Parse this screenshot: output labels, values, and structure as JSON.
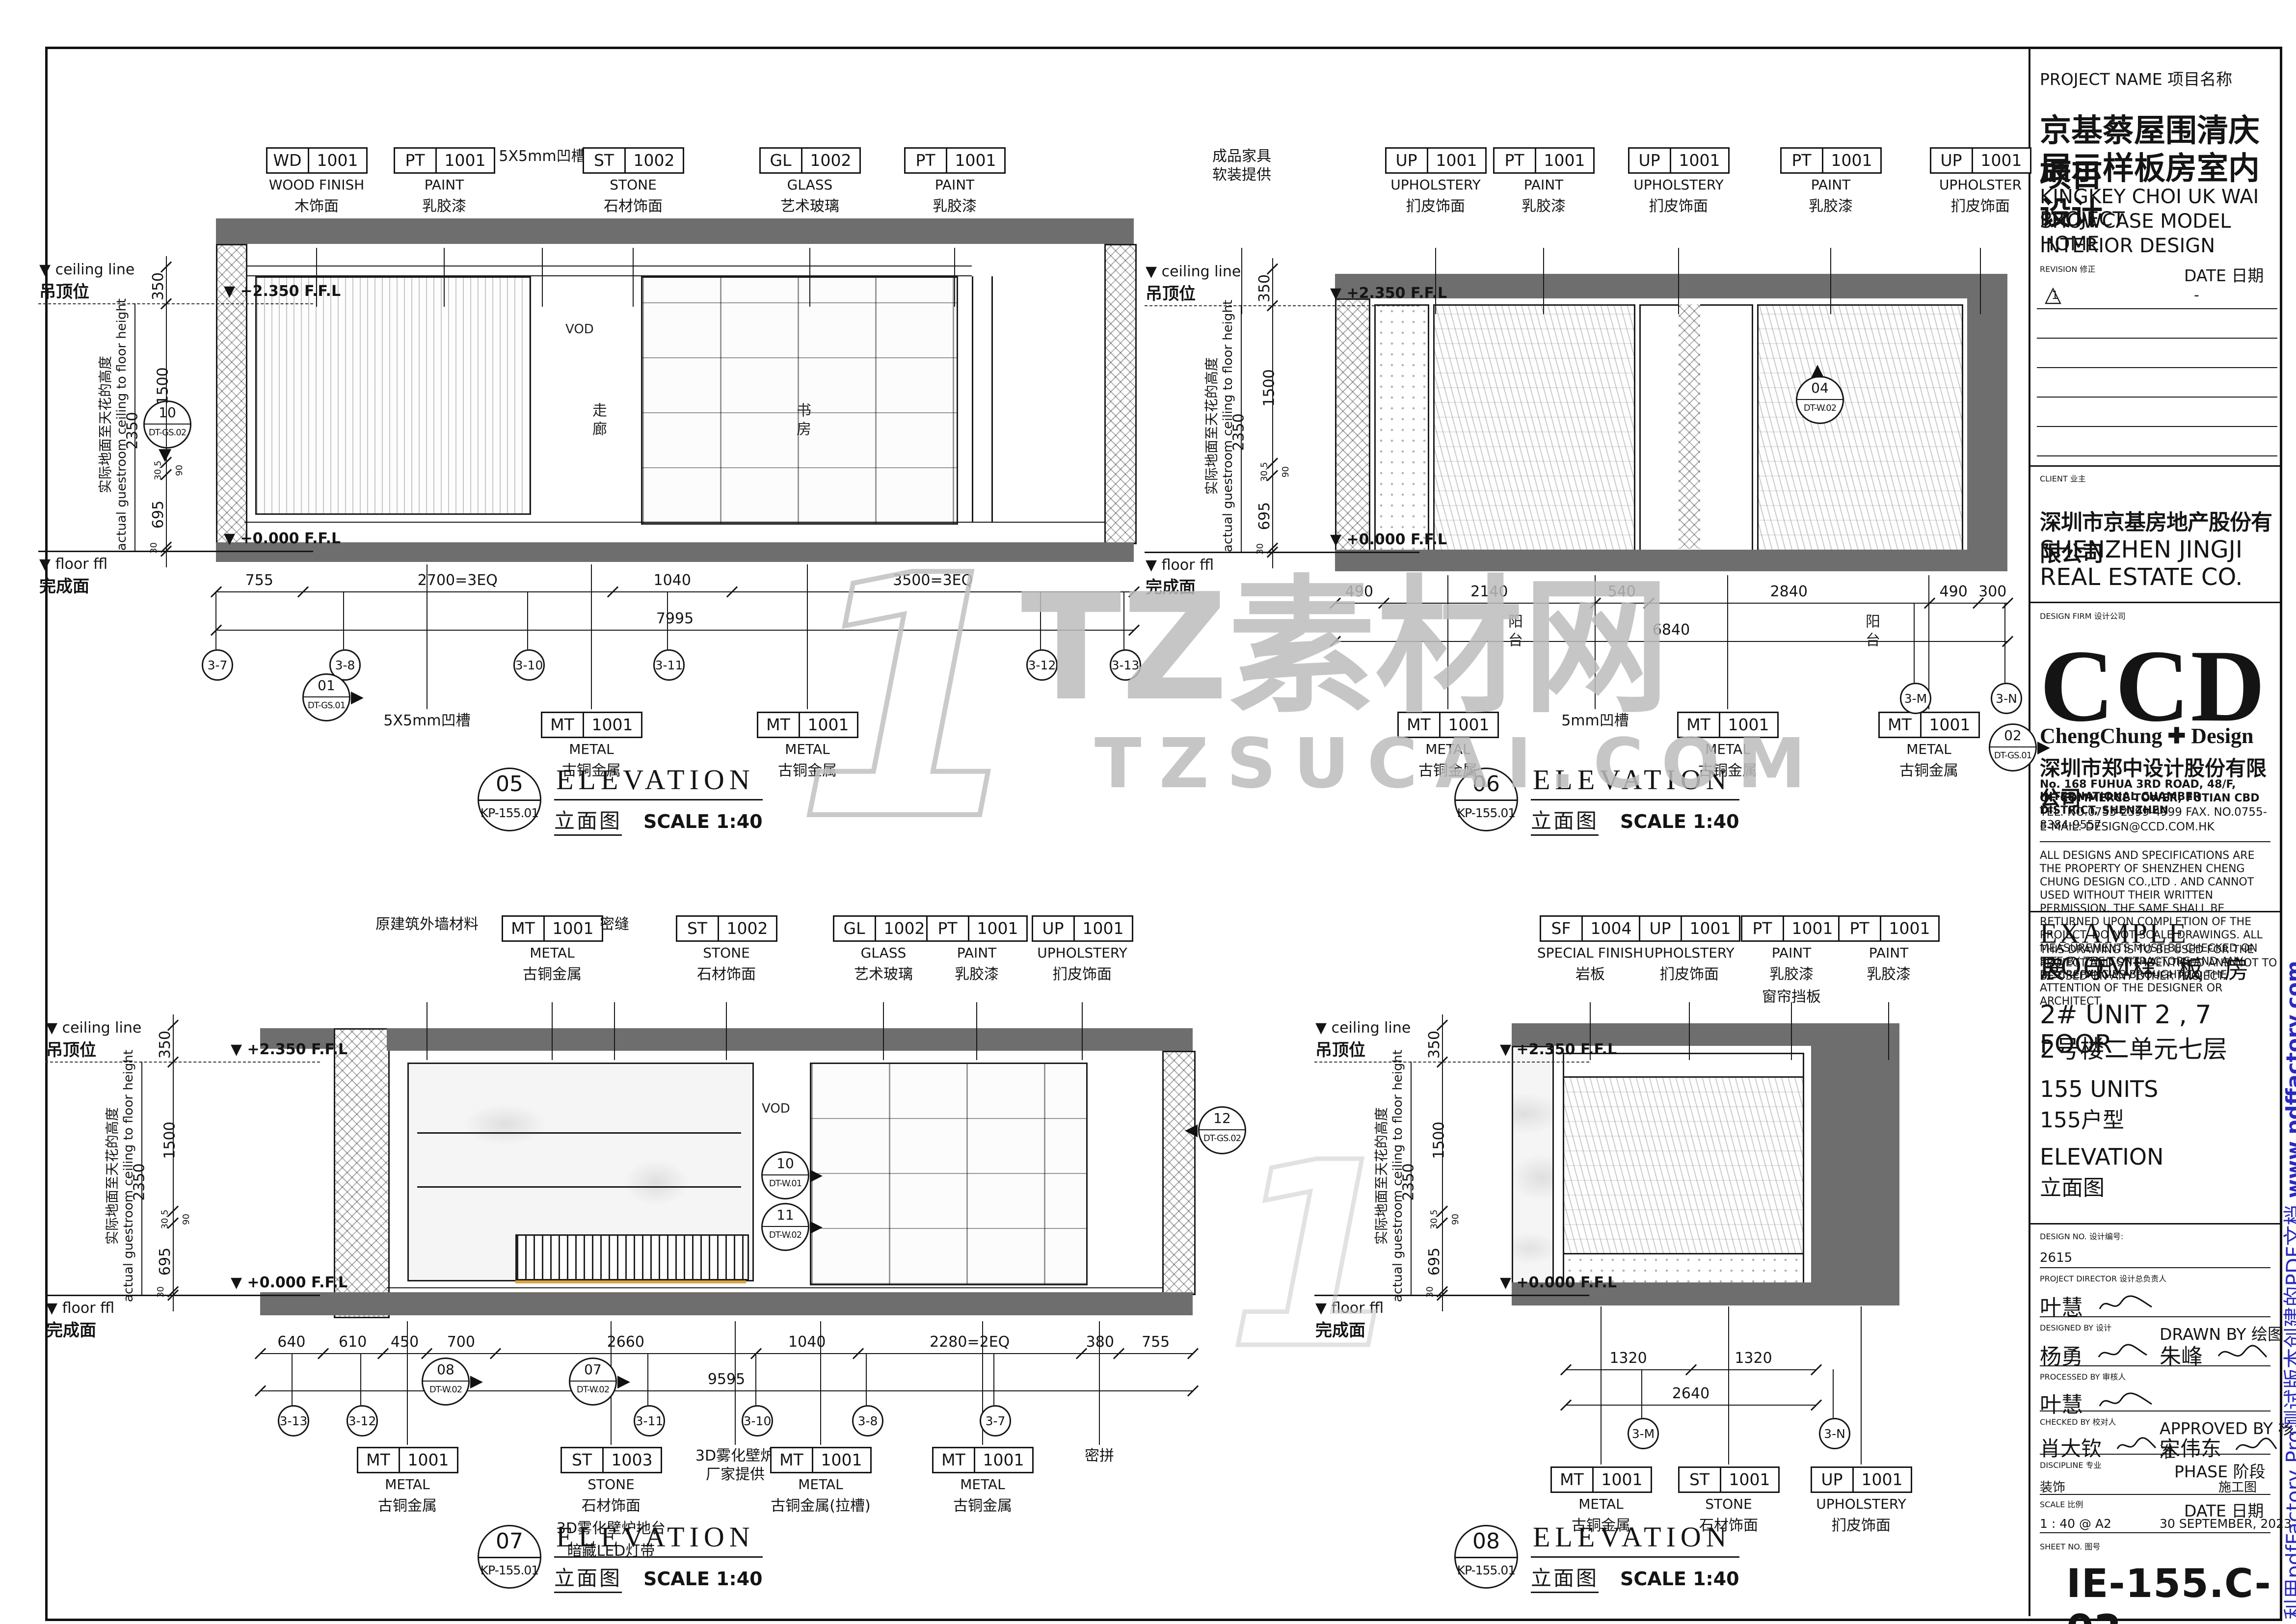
{
  "sheet": {
    "project_name_label": "PROJECT NAME 项目名称",
    "project_name_zh1": "京基蔡屋围清庆项目",
    "project_name_zh2": "展示样板房室内设计",
    "project_name_en1": "KINGKEY CHOI UK WAI PROJECT",
    "project_name_en2": "SHOWCASE MODEL HOME",
    "project_name_en3": "INTERIOR DESIGN",
    "revision_label": "REVISION 修正",
    "revision_date_label": "DATE 日期",
    "revision_mark": "1",
    "revision_date_value": "-",
    "client_label": "CLIENT 业主",
    "client_zh": "深圳市京基房地产股份有限公司",
    "client_en1": "SHENZHEN JINGJI",
    "client_en2": "REAL ESTATE CO.",
    "design_firm_label": "DESIGN FIRM 设计公司",
    "firm_logo": "CCD",
    "firm_logo_sub": "ChengChung ✚ Design",
    "firm_zh": "深圳市郑中设计股份有限公司",
    "firm_addr1": "No. 168 FUHUA 3RD ROAD, 48/F, INTERNATIONAL CHAMBER",
    "firm_addr2": "OF COMMERCE TOWER, FUTIAN CBD DISTRICT, SHENZHEN",
    "firm_tel": "TEL. NO.0755-2399-4999   FAX. NO.0755-8384-9557",
    "firm_email": "E-MAIL: DESIGN@CCD.COM.HK",
    "disclaimer1": "ALL DESIGNS AND SPECIFICATIONS ARE THE PROPERTY OF SHENZHEN CHENG CHUNG DESIGN CO.,LTD . AND CANNOT USED WITHOUT THEIR WRITTEN PERMISSION. THE SAME SHALL BE RETURNED UPON COMPLETION OF THE PROJECT. DO NOT SCALE DRAWINGS. ALL MEASUREMENTS MUST BE CHECKED ON SITE BY THE CONTRACTORS AND ANY DISCREPANCIES BROUGHT TO THE ATTENTION OF THE DESIGNER OR ARCHITECT.",
    "disclaimer2": "THIS DRAWING IS TO BE USED FOR THE PROJECT AND SITE IDENTIFIED AND NOT TO BE USED ON ANY OTHER PROJECT.",
    "area_title_en": "EXAMPLE  ROOM",
    "area_title_zh": "展 示 样 板 房",
    "unit_en": "2# UNIT 2 , 7 FOOR",
    "unit_zh": "2号楼二单元七层",
    "units_en": "155 UNITS",
    "units_zh": "155户型",
    "dwg_type_en": "ELEVATION",
    "dwg_type_zh": "立面图",
    "design_no_label": "DESIGN NO.   设计编号:",
    "design_no": "2615",
    "pd_label": "PROJECT DIRECTOR   设计总负责人",
    "pd_name": "叶慧",
    "designed_label": "DESIGNED BY 设计",
    "designed_name": "杨勇",
    "drawn_label": "DRAWN BY   绘图",
    "drawn_name": "朱峰",
    "processed_label": "PROCESSED BY 审核人",
    "processed_name": "叶慧",
    "checked_label": "CHECKED BY   校对人",
    "checked_name": "肖大钦",
    "approved_label": "APPROVED BY   核准",
    "approved_name": "宋伟东",
    "discipline_label": "DISCIPLINE   专业",
    "discipline_value": "装饰",
    "phase_label": "PHASE   阶段",
    "phase_value": "施工图",
    "scale_label": "SCALE   比例",
    "scale_value": "1 : 40 @ A2",
    "date_label": "DATE   日期",
    "date_value": "30 SEPTEMBER, 2023",
    "sheet_no_label": "SHEET NO.   图号",
    "sheet_no": "IE-155.C-02"
  },
  "watermark": {
    "logo": "1",
    "line1": "TZ素材网",
    "line2": "TZSUCAI.COM",
    "color": "#bdbdbd"
  },
  "pdf_note": {
    "text": "利用pdfFactory Pro测试版本创建的PDF文档 ",
    "url": "www.pdffactory.com",
    "color": "#2a2ac0"
  },
  "levels": {
    "ceiling_en": "ceiling line",
    "ceiling_zh": "吊顶位",
    "floor_en": "floor  ffl",
    "floor_zh": "完成面",
    "top_level": "+2.350 F.F.L",
    "bottom_level": "+0.000 F.F.L",
    "dim_above": "350",
    "dim_overall": "2350",
    "dim_upper": "1500",
    "dim_lower": "695",
    "micro_dims": [
      "30.5",
      "90",
      "30"
    ],
    "note_zh": "实际地面至天花的高度",
    "note_en": "actual guestroom ceiling to floor height"
  },
  "elevations": [
    {
      "number": "05",
      "ref": "KP-155.01",
      "title_en": "ELEVATION",
      "title_zh": "立面图",
      "scale": "SCALE  1:40",
      "tags_top": [
        {
          "code": "WD",
          "num": "1001",
          "en": "WOOD FINISH",
          "zh": "木饰面"
        },
        {
          "code": "PT",
          "num": "1001",
          "en": "PAINT",
          "zh": "乳胶漆"
        },
        {
          "note": [
            "5X5mm凹槽"
          ]
        },
        {
          "code": "ST",
          "num": "1002",
          "en": "STONE",
          "zh": "石材饰面"
        },
        {
          "code": "GL",
          "num": "1002",
          "en": "GLASS",
          "zh": "艺术玻璃"
        },
        {
          "code": "PT",
          "num": "1001",
          "en": "PAINT",
          "zh": "乳胶漆"
        }
      ],
      "tags_bottom": [
        {
          "note": [
            "5X5mm凹槽"
          ]
        },
        {
          "code": "MT",
          "num": "1001",
          "en": "METAL",
          "zh": "古铜金属"
        },
        {
          "code": "MT",
          "num": "1001",
          "en": "METAL",
          "zh": "古铜金属"
        }
      ],
      "dims": [
        "755",
        "2700=3EQ",
        "1040",
        "3500=3EQ"
      ],
      "total": "7995",
      "bubbles": [
        "3-7",
        "3-8",
        "3-10",
        "3-11",
        "3-12",
        "3-13"
      ],
      "markers": [
        {
          "no": "01",
          "ref": "DT-GS.01"
        },
        {
          "no": "10",
          "ref": "DT-GS.02"
        }
      ],
      "room_labels": [
        "走廊",
        "书房"
      ],
      "annotations": [
        "VOD"
      ]
    },
    {
      "number": "06",
      "ref": "KP-155.01",
      "title_en": "ELEVATION",
      "title_zh": "立面图",
      "scale": "SCALE  1:40",
      "tags_top": [
        {
          "note": [
            "成品家具",
            "软装提供"
          ]
        },
        {
          "code": "UP",
          "num": "1001",
          "en": "UPHOLSTERY",
          "zh": "扪皮饰面"
        },
        {
          "code": "PT",
          "num": "1001",
          "en": "PAINT",
          "zh": "乳胶漆"
        },
        {
          "code": "UP",
          "num": "1001",
          "en": "UPHOLSTERY",
          "zh": "扪皮饰面"
        },
        {
          "code": "PT",
          "num": "1001",
          "en": "PAINT",
          "zh": "乳胶漆"
        },
        {
          "code": "UP",
          "num": "1001",
          "en": "UPHOLSTER",
          "zh": "扪皮饰面"
        }
      ],
      "tags_bottom": [
        {
          "code": "MT",
          "num": "1001",
          "en": "METAL",
          "zh": "古铜金属"
        },
        {
          "note": [
            "5mm凹槽"
          ]
        },
        {
          "code": "MT",
          "num": "1001",
          "en": "METAL",
          "zh": "古铜金属"
        },
        {
          "code": "MT",
          "num": "1001",
          "en": "METAL",
          "zh": "古铜金属"
        }
      ],
      "dims": [
        "490",
        "2140",
        "540",
        "2840",
        "490",
        "300"
      ],
      "total": "6840",
      "bubbles": [
        "3-M",
        "3-N"
      ],
      "markers": [
        {
          "no": "02",
          "ref": "DT-GS.01"
        },
        {
          "no": "04",
          "ref": "DT-W.02"
        }
      ],
      "room_labels": [
        "阳台",
        "阳台"
      ],
      "annotations": []
    },
    {
      "number": "07",
      "ref": "KP-155.01",
      "title_en": "ELEVATION",
      "title_zh": "立面图",
      "scale": "SCALE  1:40",
      "tags_top": [
        {
          "note": [
            "原建筑外墙材料"
          ]
        },
        {
          "code": "MT",
          "num": "1001",
          "en": "METAL",
          "zh": "古铜金属"
        },
        {
          "note": [
            "密缝"
          ]
        },
        {
          "code": "ST",
          "num": "1002",
          "en": "STONE",
          "zh": "石材饰面"
        },
        {
          "code": "GL",
          "num": "1002",
          "en": "GLASS",
          "zh": "艺术玻璃"
        },
        {
          "code": "PT",
          "num": "1001",
          "en": "PAINT",
          "zh": "乳胶漆"
        },
        {
          "code": "UP",
          "num": "1001",
          "en": "UPHOLSTERY",
          "zh": "扪皮饰面"
        }
      ],
      "tags_bottom": [
        {
          "code": "MT",
          "num": "1001",
          "en": "METAL",
          "zh": "古铜金属"
        },
        {
          "code": "ST",
          "num": "1003",
          "en": "STONE",
          "zh": "石材饰面",
          "extra": [
            "3D雾化壁炉地台",
            "暗藏LED灯带"
          ]
        },
        {
          "note": [
            "3D雾化壁炉",
            "厂家提供"
          ]
        },
        {
          "code": "MT",
          "num": "1001",
          "en": "METAL",
          "zh": "古铜金属(拉槽)"
        },
        {
          "code": "MT",
          "num": "1001",
          "en": "METAL",
          "zh": "古铜金属"
        },
        {
          "note": [
            "密拼"
          ]
        }
      ],
      "dims": [
        "640",
        "610",
        "450",
        "700",
        "2660",
        "1040",
        "2280=2EQ",
        "380",
        "755"
      ],
      "total": "9595",
      "bubbles": [
        "3-13",
        "3-12",
        "3-11",
        "3-10",
        "3-8",
        "3-7"
      ],
      "markers": [
        {
          "no": "08",
          "ref": "DT-W.02"
        },
        {
          "no": "07",
          "ref": "DT-W.02"
        },
        {
          "no": "10",
          "ref": "DT-W.01"
        },
        {
          "no": "11",
          "ref": "DT-W.02"
        },
        {
          "no": "12",
          "ref": "DT-GS.02"
        }
      ],
      "room_labels": [],
      "annotations": [
        "VOD"
      ]
    },
    {
      "number": "08",
      "ref": "KP-155.01",
      "title_en": "ELEVATION",
      "title_zh": "立面图",
      "scale": "SCALE  1:40",
      "tags_top": [
        {
          "code": "SF",
          "num": "1004",
          "en": "SPECIAL FINISH",
          "zh": "岩板"
        },
        {
          "code": "UP",
          "num": "1001",
          "en": "UPHOLSTERY",
          "zh": "扪皮饰面"
        },
        {
          "code": "PT",
          "num": "1001",
          "en": "PAINT",
          "zh": "乳胶漆",
          "extra": [
            "窗帘挡板"
          ]
        },
        {
          "code": "PT",
          "num": "1001",
          "en": "PAINT",
          "zh": "乳胶漆"
        }
      ],
      "tags_bottom": [
        {
          "code": "MT",
          "num": "1001",
          "en": "METAL",
          "zh": "古铜金属"
        },
        {
          "code": "ST",
          "num": "1001",
          "en": "STONE",
          "zh": "石材饰面"
        },
        {
          "code": "UP",
          "num": "1001",
          "en": "UPHOLSTERY",
          "zh": "扪皮饰面"
        }
      ],
      "dims": [
        "1320",
        "1320"
      ],
      "total": "2640",
      "bubbles": [
        "3-M",
        "3-N"
      ],
      "markers": [],
      "room_labels": [],
      "annotations": []
    }
  ]
}
